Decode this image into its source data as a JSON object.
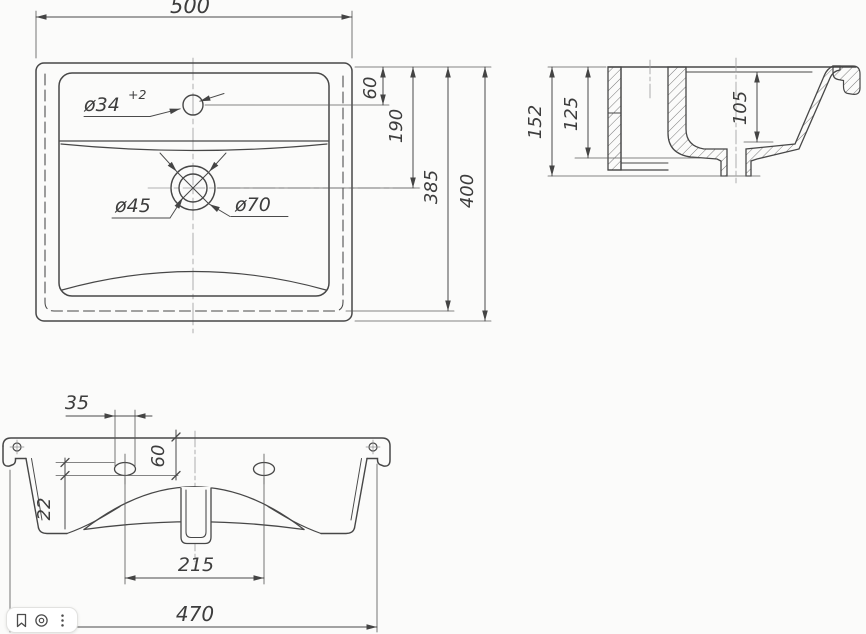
{
  "page": {
    "background": "#fbfbfa",
    "line_color": "#474747"
  },
  "top_view": {
    "overall_width": "500",
    "faucet_offset": "60",
    "drain_offset": "190",
    "inner_depth": "385",
    "overall_depth": "400",
    "faucet_hole": "ø34",
    "faucet_tolerance": "+2",
    "drain_inner": "ø45",
    "drain_outer": "ø70"
  },
  "section_view": {
    "overall_height": "152",
    "back_height": "125",
    "bowl_depth": "105"
  },
  "front_view": {
    "slot_length": "35",
    "slot_offset": "60",
    "slot_width": "22",
    "slot_spacing": "215",
    "base_width": "470"
  },
  "toolbar": {
    "buttons": [
      {
        "name": "bookmark"
      },
      {
        "name": "image-search"
      },
      {
        "name": "more"
      }
    ]
  }
}
